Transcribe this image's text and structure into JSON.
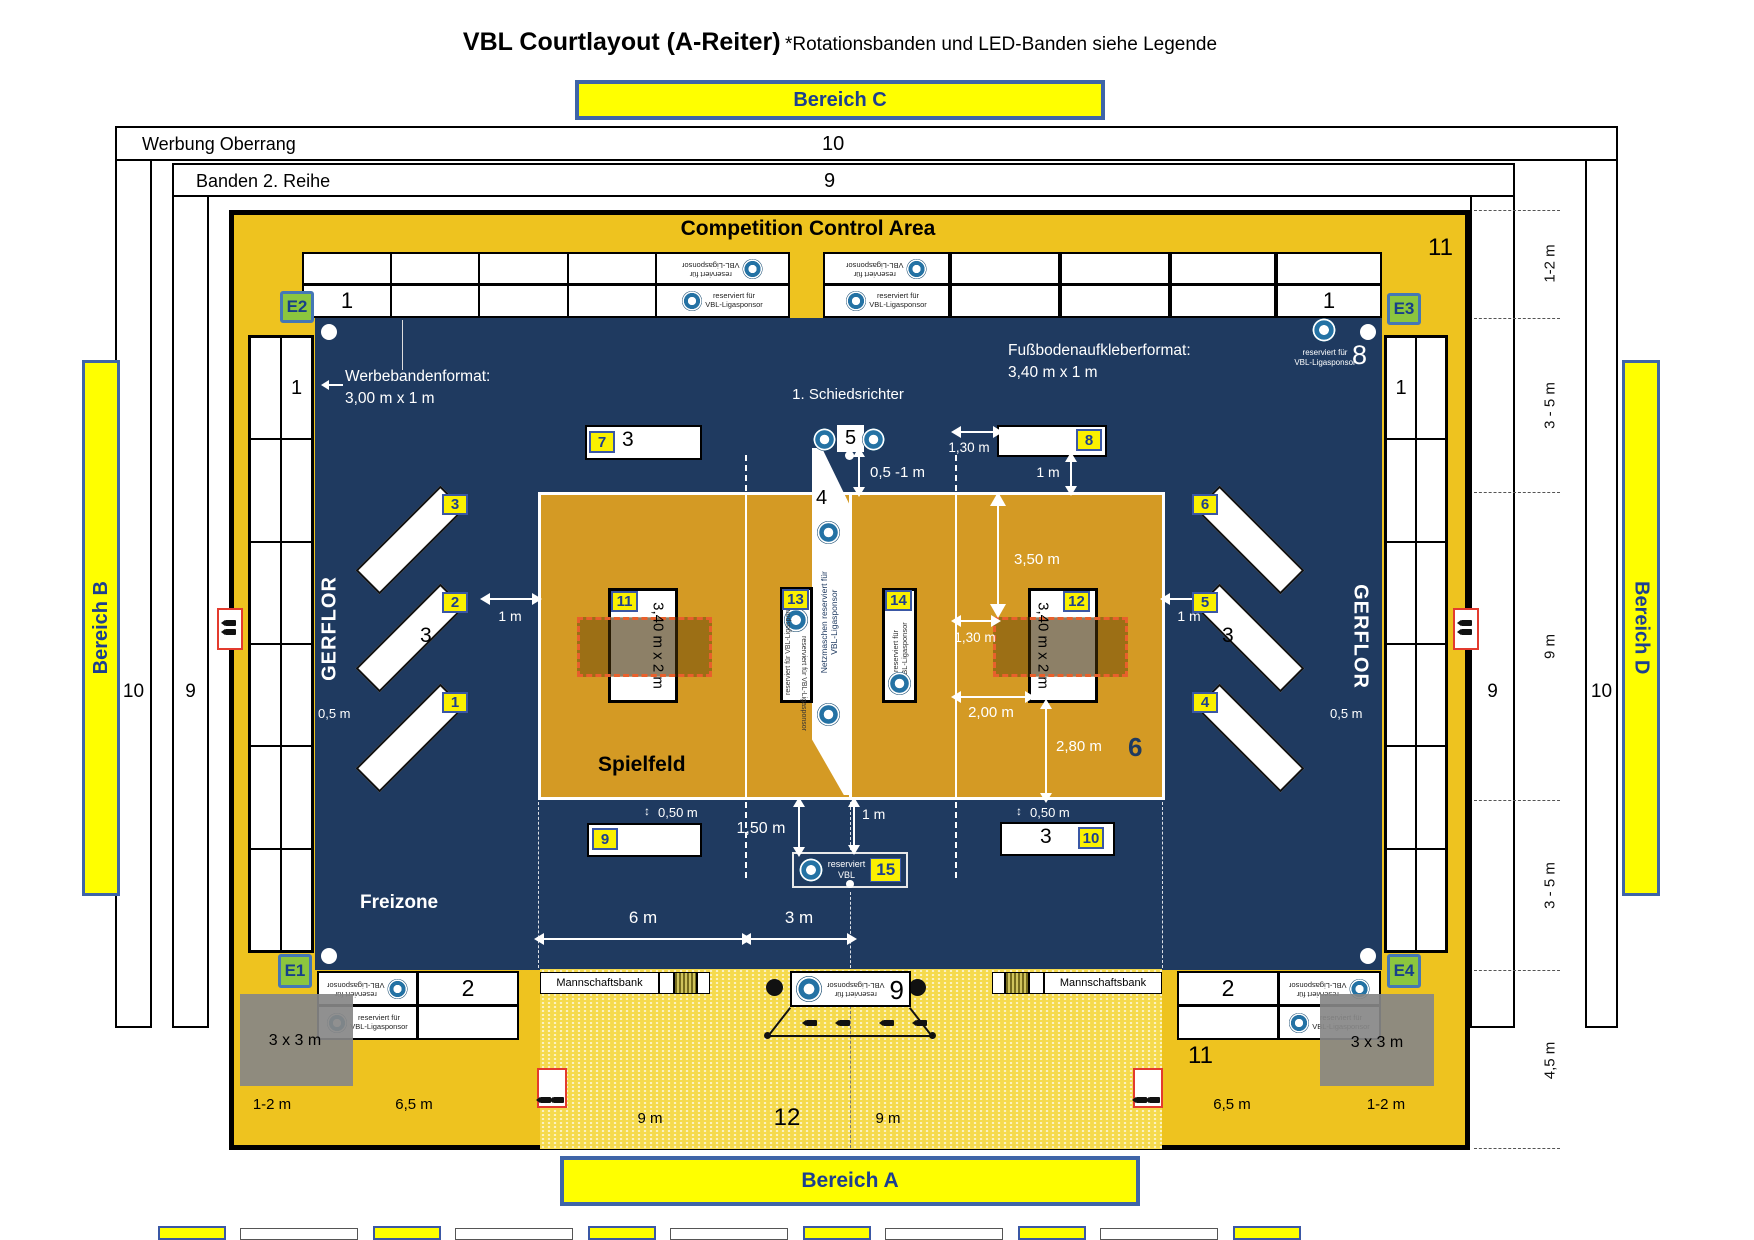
{
  "title": {
    "main": "VBL Courtlayout (A-Reiter)",
    "subtitle": "*Rotationsbanden und LED-Banden siehe Legende"
  },
  "areas": {
    "a": "Bereich A",
    "b": "Bereich B",
    "c": "Bereich C",
    "d": "Bereich D"
  },
  "perimeter": {
    "oberrang_label": "Werbung Oberrang",
    "oberrang_count": "10",
    "banden2_label": "Banden 2. Reihe",
    "banden2_count": "9"
  },
  "main": {
    "control_area": "Competition Control Area",
    "gerflor": "GERFLOR",
    "freizone": "Freizone",
    "spielfeld": "Spielfeld",
    "mannschaftsbank": "Mannschaftsbank",
    "schiedsrichter": "1. Schiedsrichter"
  },
  "sponsor": {
    "line1": "reserviert für",
    "line2": "VBL-Ligasponsor"
  },
  "net_sponsor": {
    "line1": "Netzmaschen reserviert für",
    "line2": "VBL-Ligasponsor"
  },
  "vbl_reserved": {
    "line1": "reserviert",
    "line2": "VBL"
  },
  "annotations": {
    "werbeband_line1": "Werbebandenformat:",
    "werbeband_line2": "3,00 m x 1 m",
    "fussboden_line1": "Fußbodenaufkleberformat:",
    "fussboden_line2": "3,40 m x 1 m",
    "sticker_size": "3,40 m x 2 m",
    "box_3x3": "3 x 3 m"
  },
  "badges": {
    "e1": "E1",
    "e2": "E2",
    "e3": "E3",
    "e4": "E4",
    "n1": "1",
    "n2": "2",
    "n3": "3",
    "n4": "4",
    "n5": "5",
    "n6": "6",
    "n7": "7",
    "n8": "8",
    "n9": "9",
    "n10": "10",
    "n11": "11",
    "n12": "12",
    "n13": "13",
    "n14": "14",
    "n15": "15"
  },
  "counts": {
    "banner_row": "1",
    "banner7": "3",
    "diag": "3",
    "banner10": "3",
    "bench": "2",
    "court_right": "6",
    "gold_topright": "11",
    "gold_bottom": "11",
    "center_bottom": "12",
    "net_stand": "4",
    "net_top": "5",
    "ref_corner": "8",
    "rot_bench": "6"
  },
  "dims": {
    "m05": "0,5 m",
    "m1": "1 m",
    "m05_1": "0,5 -1 m",
    "m130": "1,30 m",
    "m350": "3,50 m",
    "m200": "2,00 m",
    "m280": "2,80 m",
    "m050": "0,50 m",
    "m150": "1,50 m",
    "m6": "6 m",
    "m3": "3 m",
    "m9": "9 m",
    "m65": "6,5 m",
    "m12": "1-2 m",
    "m35": "3 - 5 m",
    "m45": "4,5 m"
  },
  "colors": {
    "gold": "#eec31f",
    "navy": "#1f3a60",
    "court": "#d49a24",
    "badge_yellow": "#faf000",
    "badge_green": "#8cc63e",
    "accent_blue": "#3a57a5",
    "red": "#e33b2e"
  }
}
